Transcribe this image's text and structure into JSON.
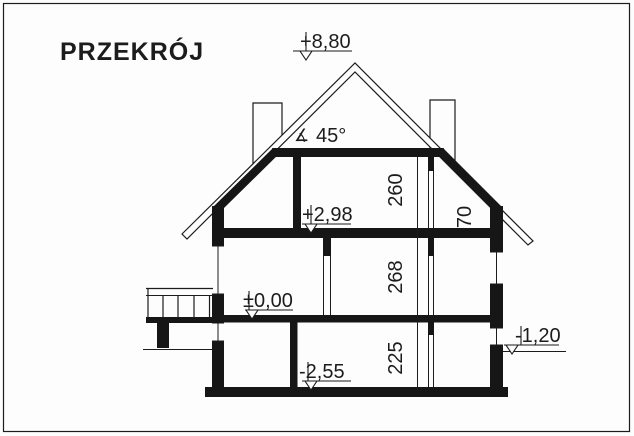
{
  "title": "PRZEKRÓJ",
  "roof": {
    "angle_symbol": "∡",
    "angle": "45°"
  },
  "levels": {
    "ridge": "+8,80",
    "attic_floor": "+2,98",
    "ground_floor": "±0,00",
    "basement_floor": "-2,55",
    "terrain": "-1,20"
  },
  "room_heights": {
    "attic": "260",
    "knee_wall": "70",
    "ground_floor": "268",
    "basement": "225"
  }
}
